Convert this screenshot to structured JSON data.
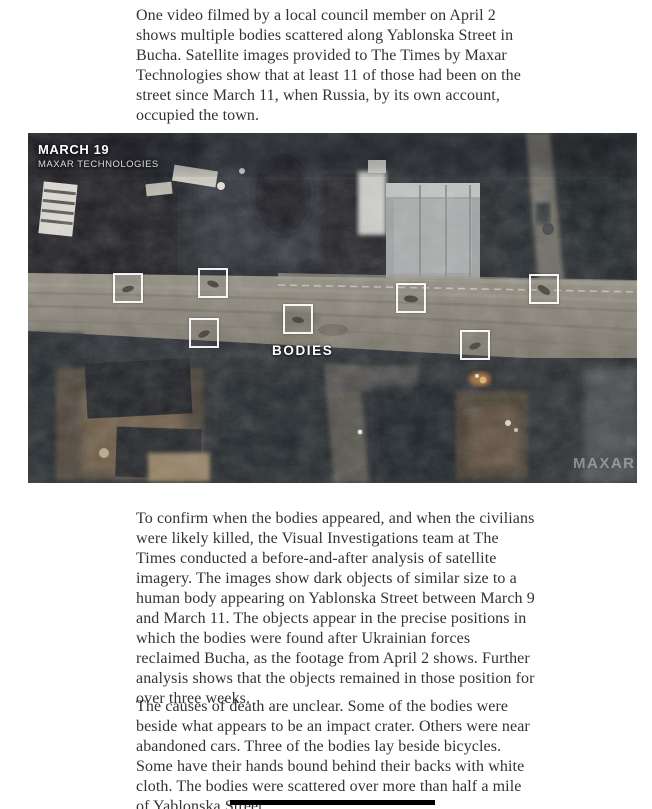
{
  "article": {
    "paragraph1": "One video filmed by a local council member on April 2 shows multiple bodies scattered along Yablonska Street in Bucha. Satellite images provided to The Times by Maxar Technologies show that at least 11 of those had been on the street since March 11, when Russia, by its own account, occupied the town.",
    "paragraph2": "To confirm when the bodies appeared, and when the civilians were likely killed, the Visual Investigations team at The Times conducted a before-and-after analysis of satellite imagery. The images show dark objects of similar size to a human body appearing on Yablonska Street between March 9 and March 11. The objects appear in the precise positions in which the bodies were found after Ukrainian forces reclaimed Bucha, as the footage from April 2 shows. Further analysis shows that the objects remained in those position for over three weeks.",
    "paragraph3": "The causes of death are unclear. Some of the bodies were beside what appears to be an impact crater. Others were near abandoned cars. Three of the bodies lay beside bicycles. Some have their hands bound behind their backs with white cloth. The bodies were scattered over more than half a mile of Yablonska Street."
  },
  "satellite_figure": {
    "date_label": "MARCH 19",
    "source_label": "MAXAR TECHNOLOGIES",
    "annotation_label": "BODIES",
    "watermark": "MAXAR",
    "bodies_marked": 7
  },
  "colors": {
    "body_text": "#333333",
    "marker_border": "#ffffff",
    "divider": "#000000",
    "road": "#8a857a",
    "dark_terrain": "#1d2126"
  }
}
